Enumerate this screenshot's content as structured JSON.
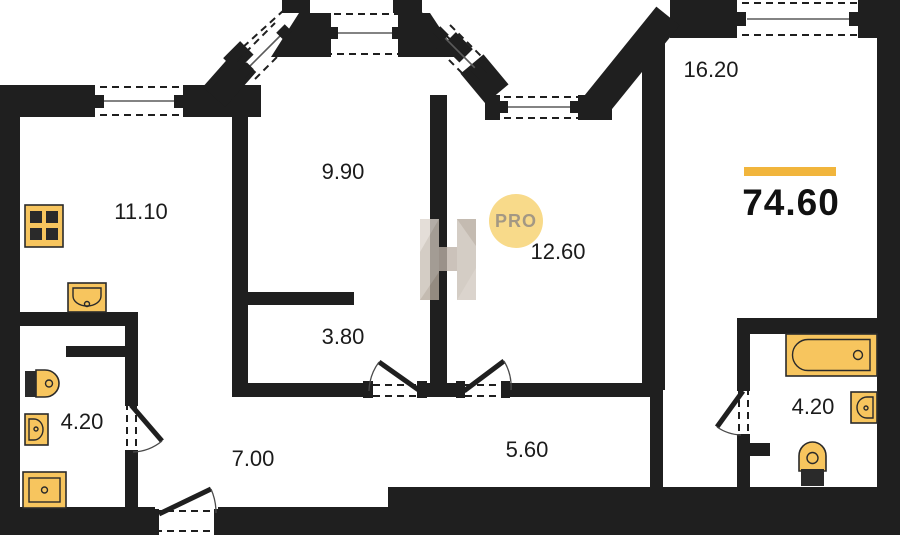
{
  "plan": {
    "total_area_value": "74.60",
    "rooms": [
      {
        "name": "kitchen",
        "area": "11.10"
      },
      {
        "name": "living-room",
        "area": "9.90"
      },
      {
        "name": "bedroom-large",
        "area": "16.20"
      },
      {
        "name": "bedroom",
        "area": "12.60"
      },
      {
        "name": "wardrobe",
        "area": "3.80"
      },
      {
        "name": "bathroom-left",
        "area": "4.20"
      },
      {
        "name": "hallway",
        "area": "7.00"
      },
      {
        "name": "corridor",
        "area": "5.60"
      },
      {
        "name": "bathroom-right",
        "area": "4.20"
      }
    ],
    "watermark": {
      "logo_letter": "H",
      "badge_label": "PRO"
    },
    "fixtures": [
      "stove-icon",
      "kitchen-sink-icon",
      "toilet-icon",
      "washbasin-icon",
      "shower-tray-icon",
      "bathtub-icon",
      "washbasin-icon",
      "toilet-icon"
    ],
    "colors": {
      "wall": "#1f1f1f",
      "fixture_fill": "#f7c55e",
      "accent_bar": "#f1b53c",
      "badge_bg": "#f8da8a",
      "badge_text": "#a39884",
      "watermark_gray": "#c9bfb5"
    }
  }
}
